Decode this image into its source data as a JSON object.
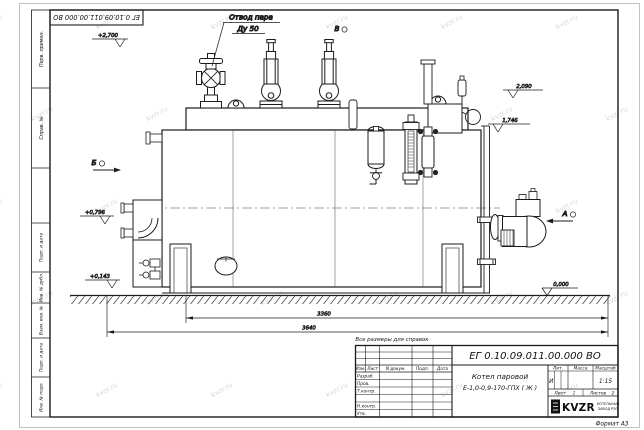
{
  "watermark": {
    "text": "kvzr.ru"
  },
  "frame": {
    "top_stamp": "ЕГ 0.10.09.011.00.000  ВО",
    "margin_labels": [
      "Перв. примен.",
      "Справ. №",
      "Подп. и дата",
      "Инв. № дубл.",
      "Взам. инв. №",
      "Подп. и дата",
      "Инв. № подл."
    ],
    "format_note": "Формат А3"
  },
  "drawing": {
    "callout": {
      "line1": "Отвод пара",
      "line2": "Ду 50"
    },
    "views": {
      "a": "А",
      "b": "Б",
      "v": "В"
    },
    "elevations": [
      {
        "value": "+2,700"
      },
      {
        "value": "2,090"
      },
      {
        "value": "1,746"
      },
      {
        "value": "+0,796"
      },
      {
        "value": "+0,143"
      },
      {
        "value": "0,000"
      }
    ],
    "dimensions": [
      {
        "value": "3360"
      },
      {
        "value": "3640"
      }
    ],
    "reference_note": "Все размеры для справок"
  },
  "title_block": {
    "designation": "ЕГ 0.10.09.011.00.000  ВО",
    "product": {
      "line1": "Котел паровой",
      "line2": "Е-1,0-0,9-170-ГПХ ( Ж )"
    },
    "columns": {
      "izm": "Изм.",
      "list": "Лист",
      "doc": "N докум.",
      "sign": "Подп.",
      "date": "Дата"
    },
    "rows": {
      "developer": "Разраб.",
      "checker": "Пров.",
      "tcontrol": "Т.контр.",
      "ncontrol": "Н.контр.",
      "approver": "Утв."
    },
    "lit": {
      "header": "Лит.",
      "value": "И"
    },
    "mass": {
      "header": "Масса"
    },
    "scale": {
      "header": "Масштаб",
      "value": "1:15"
    },
    "sheet": {
      "label": "Лист",
      "value": "1"
    },
    "sheets": {
      "label": "Листов",
      "value": "2"
    },
    "logo": {
      "name": "KVZR",
      "org_line1": "КОТЕЛЬНЫЙ",
      "org_line2": "ЗАВОД РЭП"
    }
  }
}
